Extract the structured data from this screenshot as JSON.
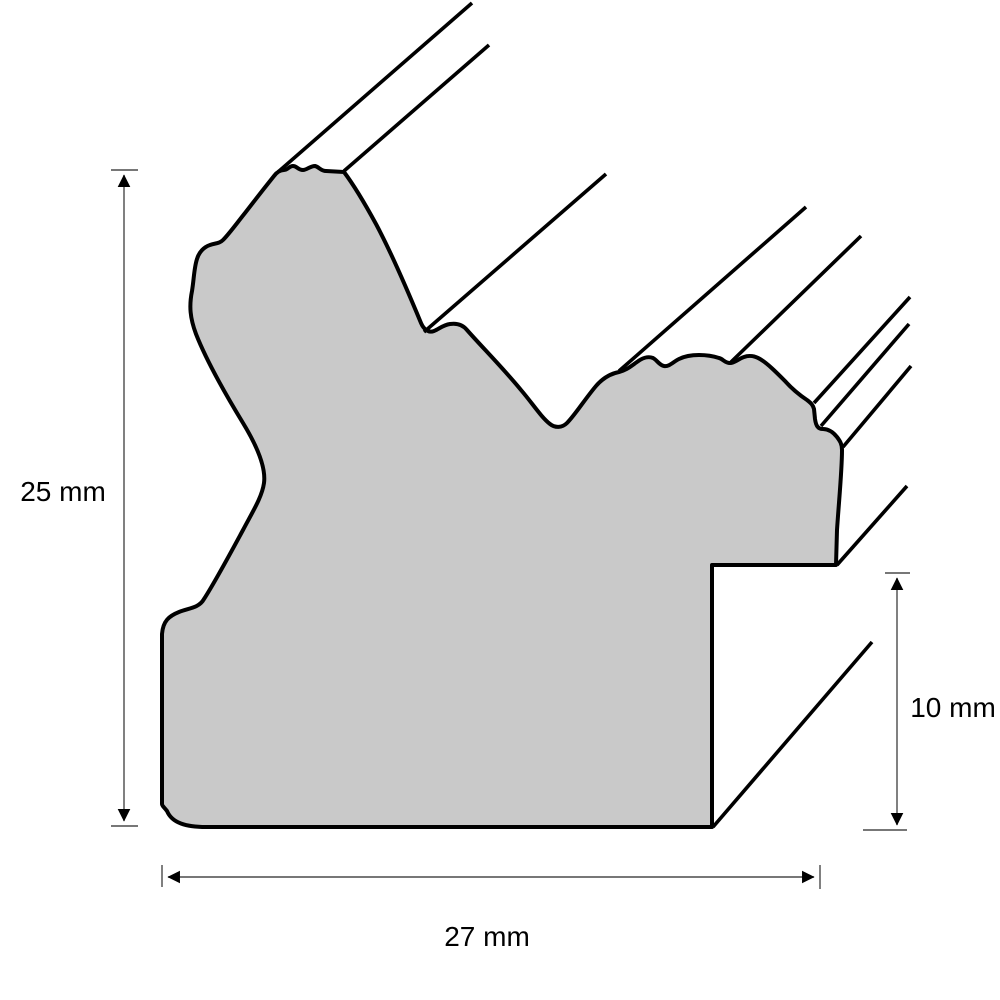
{
  "diagram": {
    "kind": "picture-frame-moulding-cross-section",
    "labels": {
      "height": "25 mm",
      "rabbet_depth": "10 mm",
      "width": "27 mm"
    },
    "dimensions_mm": {
      "height": 25,
      "width": 27,
      "rabbet_depth": 10
    },
    "colors": {
      "profile_fill": "#C9C9C9",
      "outline": "#000000",
      "dimension_line": "#4a4a4a",
      "background": "#FFFFFF"
    }
  }
}
